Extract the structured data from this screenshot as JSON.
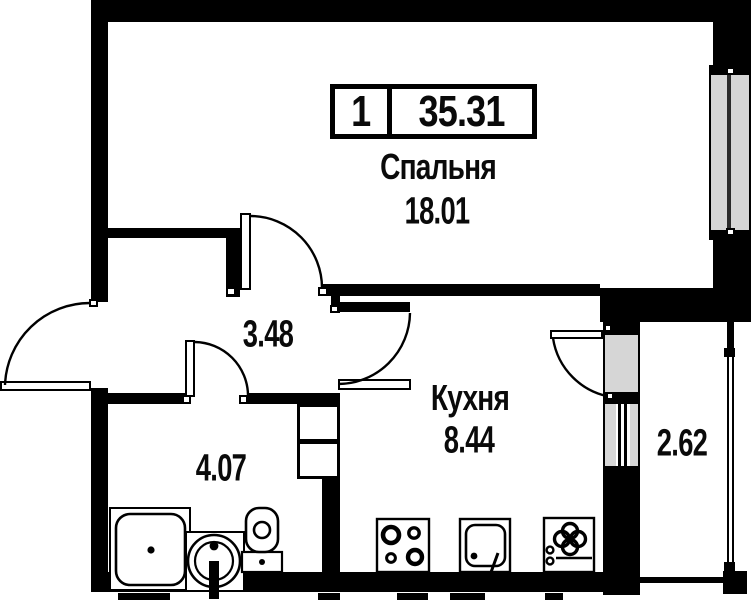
{
  "title_badge": {
    "room_count": "1",
    "total_area": "35.31"
  },
  "rooms": {
    "bedroom": {
      "label": "Спальня",
      "area": "18.01"
    },
    "hallway": {
      "area": "3.48"
    },
    "kitchen": {
      "label": "Кухня",
      "area": "8.44"
    },
    "bathroom": {
      "area": "4.07"
    },
    "balcony": {
      "area": "2.62"
    }
  },
  "fixtures": [
    "shower-tray",
    "washbasin",
    "toilet",
    "stove",
    "kitchen-sink",
    "washing-machine"
  ],
  "openings": [
    "entrance-door",
    "bedroom-door",
    "bathroom-door",
    "kitchen-door",
    "balcony-door",
    "bedroom-window",
    "balcony-glazing"
  ],
  "colors": {
    "walls": "#000000",
    "glass": "#d6d6d6",
    "paper": "#ffffff",
    "text": "#0a0a0a"
  }
}
